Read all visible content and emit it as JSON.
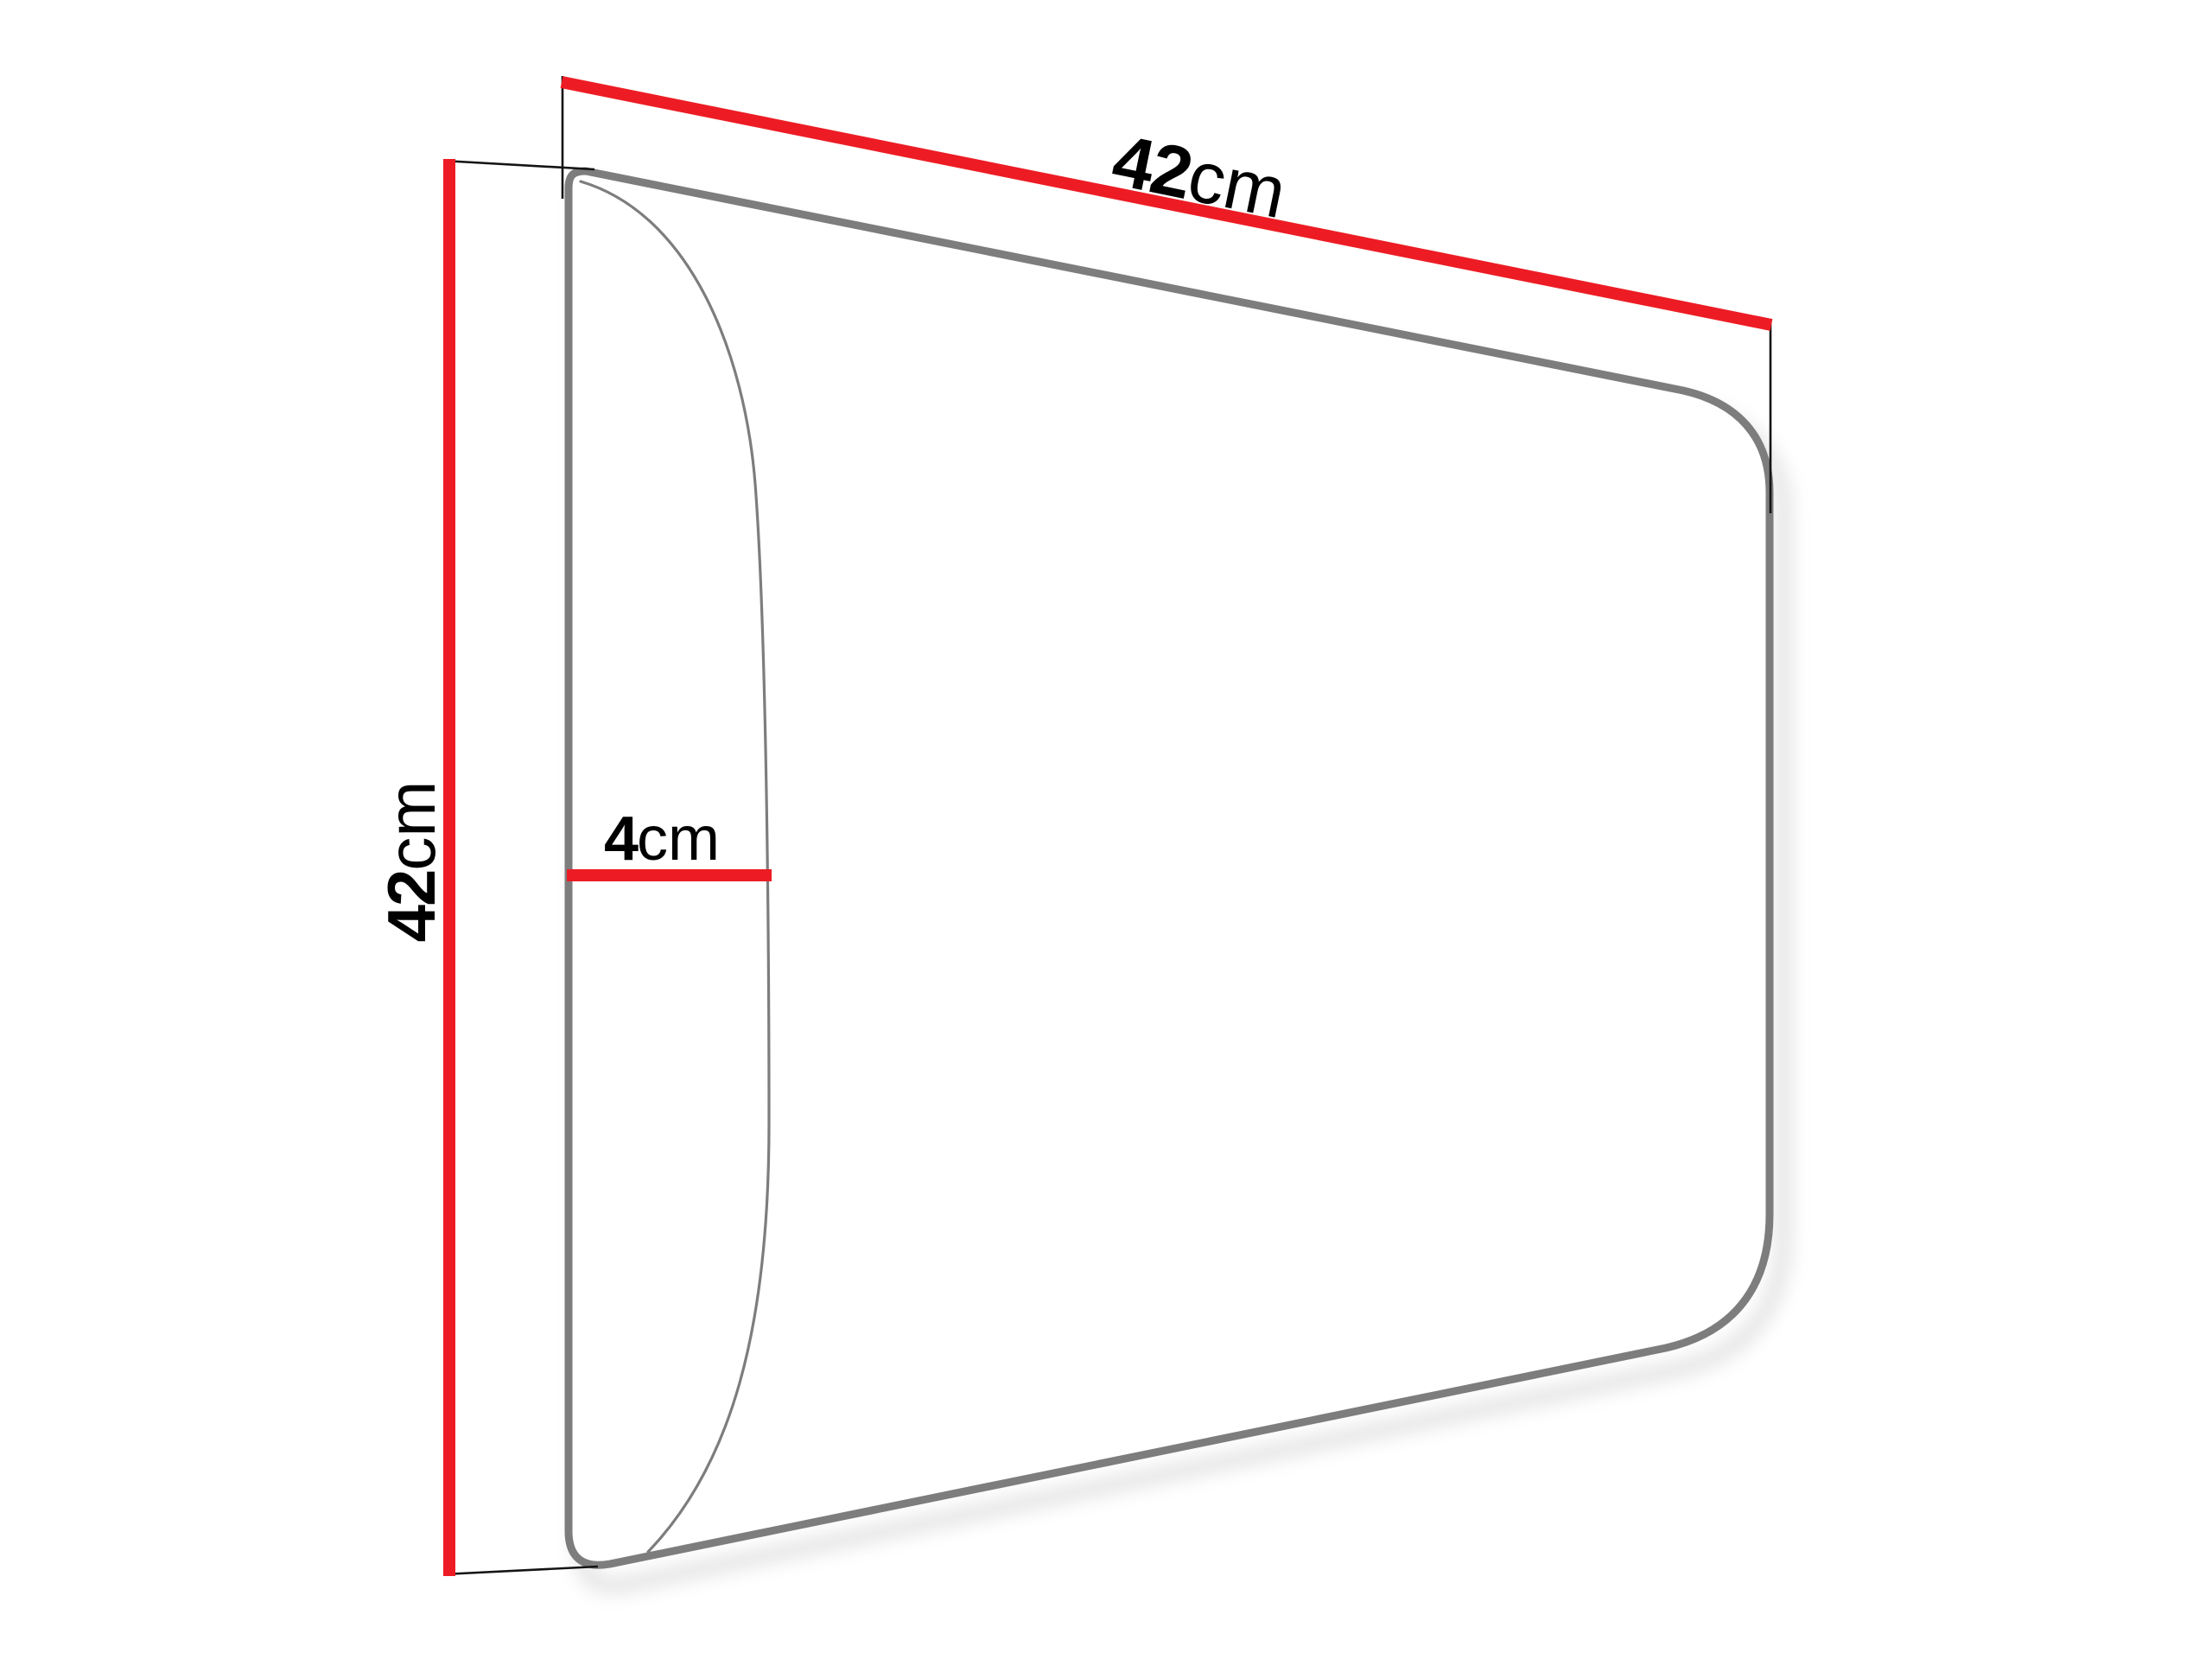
{
  "diagram": {
    "kind": "product-dimension-diagram",
    "subject": "upholstered-wall-panel-perspective-view"
  },
  "colors": {
    "dimension_red": "#ed1c24",
    "outline_gray": "#7d7d7d",
    "extension_black": "#141414",
    "shadow_gray": "#aaaaaa",
    "background": "#ffffff",
    "text": "#000000"
  },
  "dimensions": {
    "width": {
      "value": "42",
      "unit": "cm"
    },
    "height": {
      "value": "42",
      "unit": "cm"
    },
    "depth": {
      "value": "4",
      "unit": "cm"
    }
  }
}
